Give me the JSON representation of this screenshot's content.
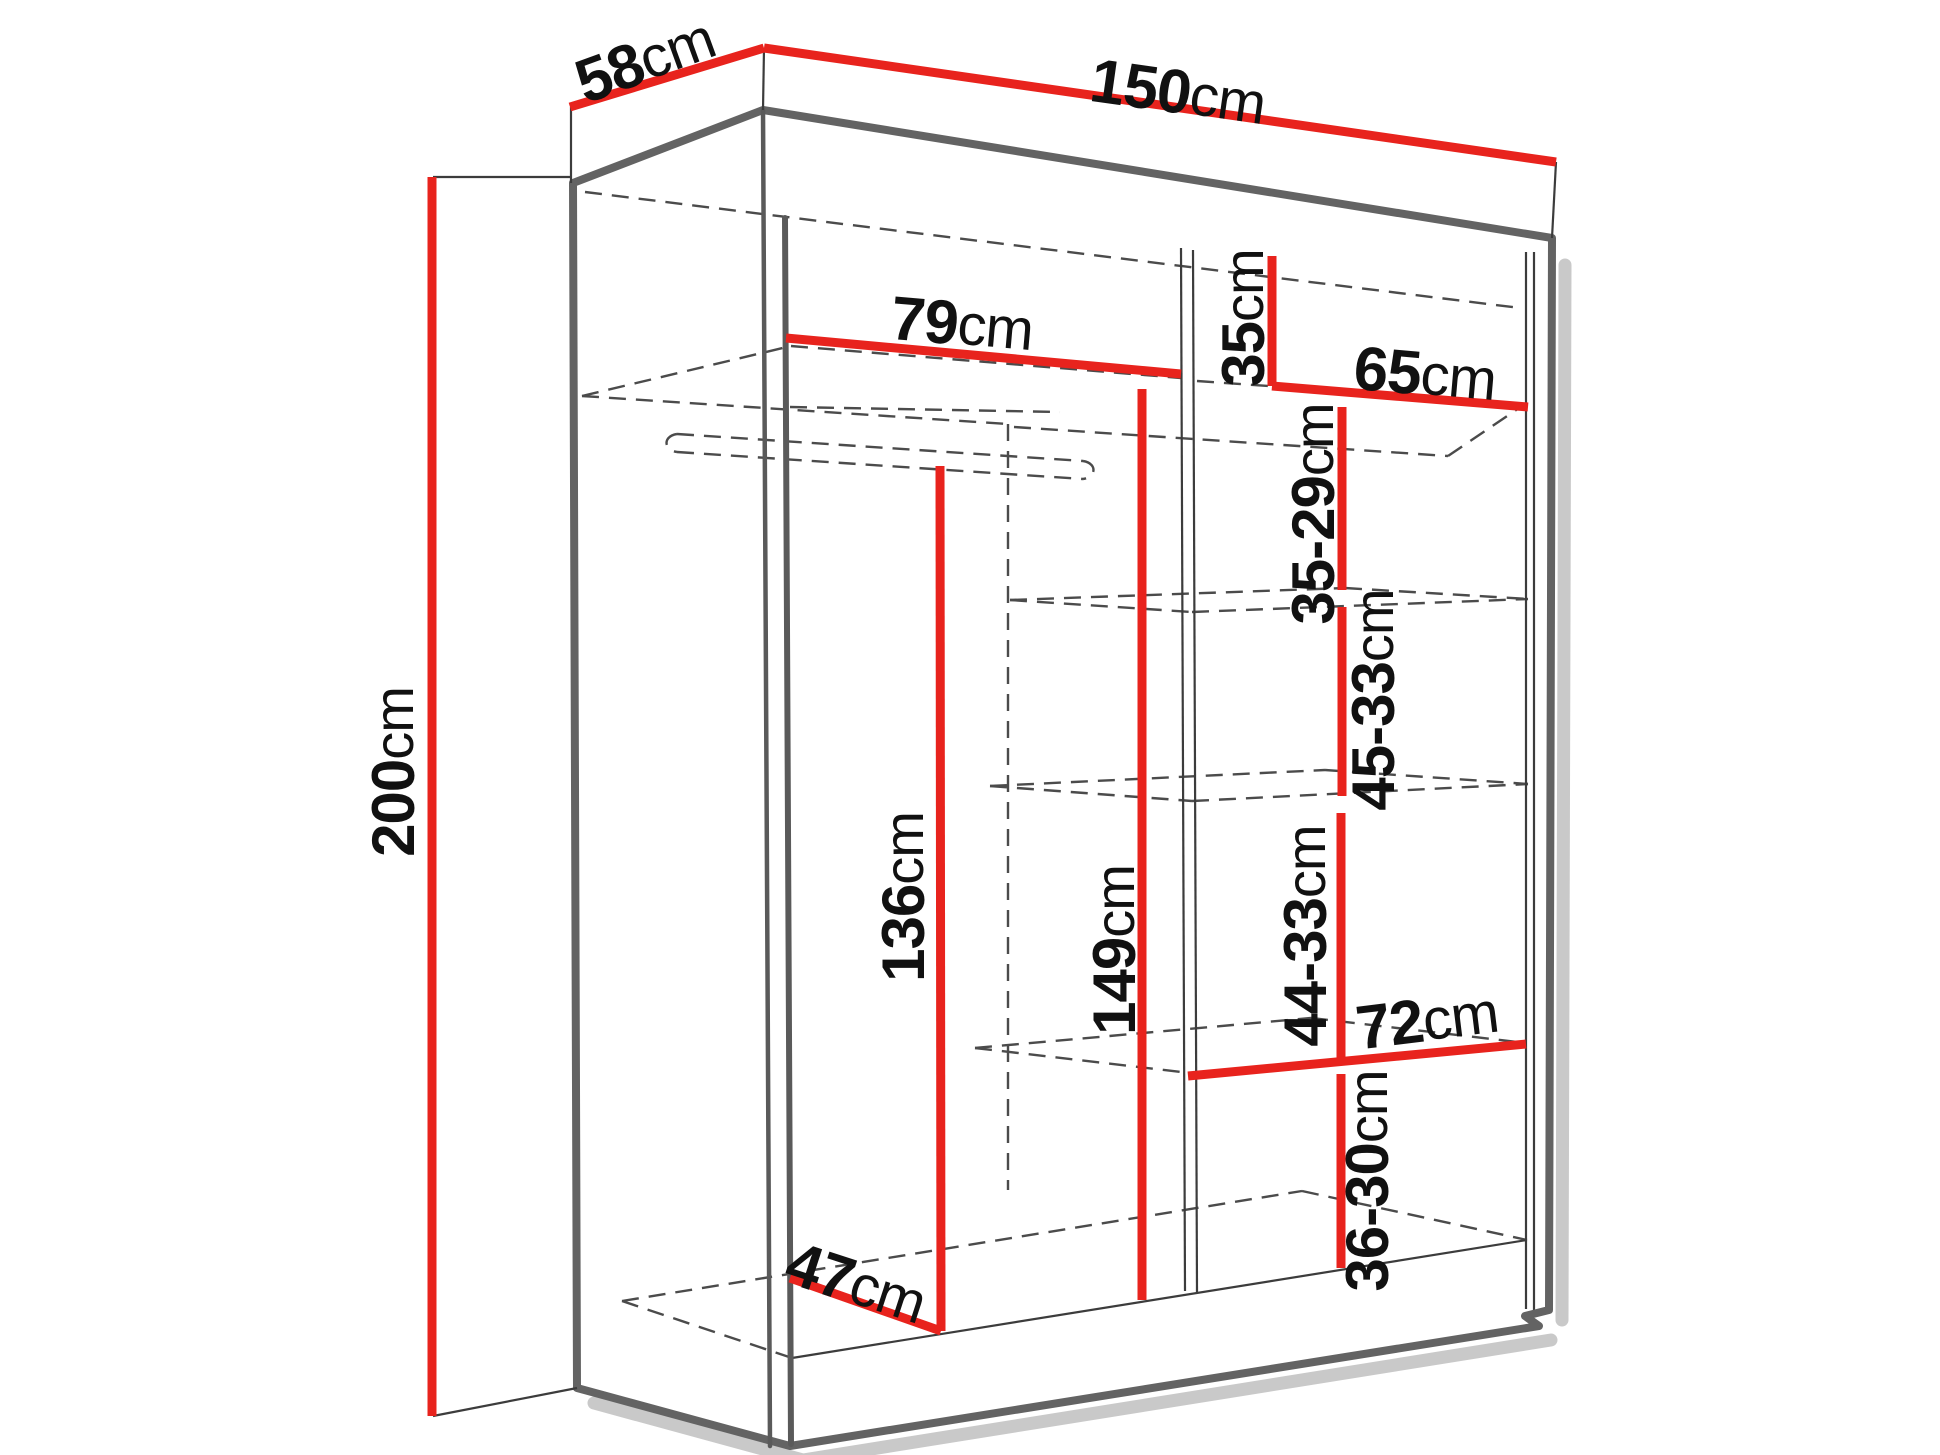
{
  "diagram": {
    "type": "furniture-dimension-diagram",
    "subject": "sliding-door wardrobe wireframe, perspective view",
    "units": "cm"
  },
  "colors": {
    "dimension_line": "#e8231d",
    "outline": "#636363",
    "hidden_line": "#4b4b4b",
    "shadow": "#c9c9c9",
    "label_text": "#111111",
    "background": "#ffffff"
  },
  "dims": {
    "depth": {
      "v": "58",
      "u": "cm"
    },
    "width": {
      "v": "150",
      "u": "cm"
    },
    "height": {
      "v": "200",
      "u": "cm"
    },
    "left_width": {
      "v": "79",
      "u": "cm"
    },
    "top_gap": {
      "v": "35",
      "u": "cm"
    },
    "right_width": {
      "v": "65",
      "u": "cm"
    },
    "gap1": {
      "v": "35-29",
      "u": "cm"
    },
    "gap2": {
      "v": "45-33",
      "u": "cm"
    },
    "hang_height": {
      "v": "136",
      "u": "cm"
    },
    "interior_height": {
      "v": "149",
      "u": "cm"
    },
    "gap3": {
      "v": "44-33",
      "u": "cm"
    },
    "shelf_width": {
      "v": "72",
      "u": "cm"
    },
    "gap4": {
      "v": "36-30",
      "u": "cm"
    },
    "usable_depth": {
      "v": "47",
      "u": "cm"
    }
  },
  "structure": {
    "overall": {
      "width_cm": "150",
      "depth_cm": "58",
      "height_cm": "200"
    },
    "left_section": {
      "width_cm": "79",
      "hanging_rail_height_cm": "136",
      "interior_height_cm": "149",
      "usable_depth_cm": "47"
    },
    "right_section": {
      "width_cm": "65",
      "top_shelf_offset_cm": "35",
      "shelf_gaps_cm": [
        "35-29",
        "45-33",
        "44-33",
        "36-30"
      ],
      "lower_shelf_width_cm": "72"
    }
  }
}
